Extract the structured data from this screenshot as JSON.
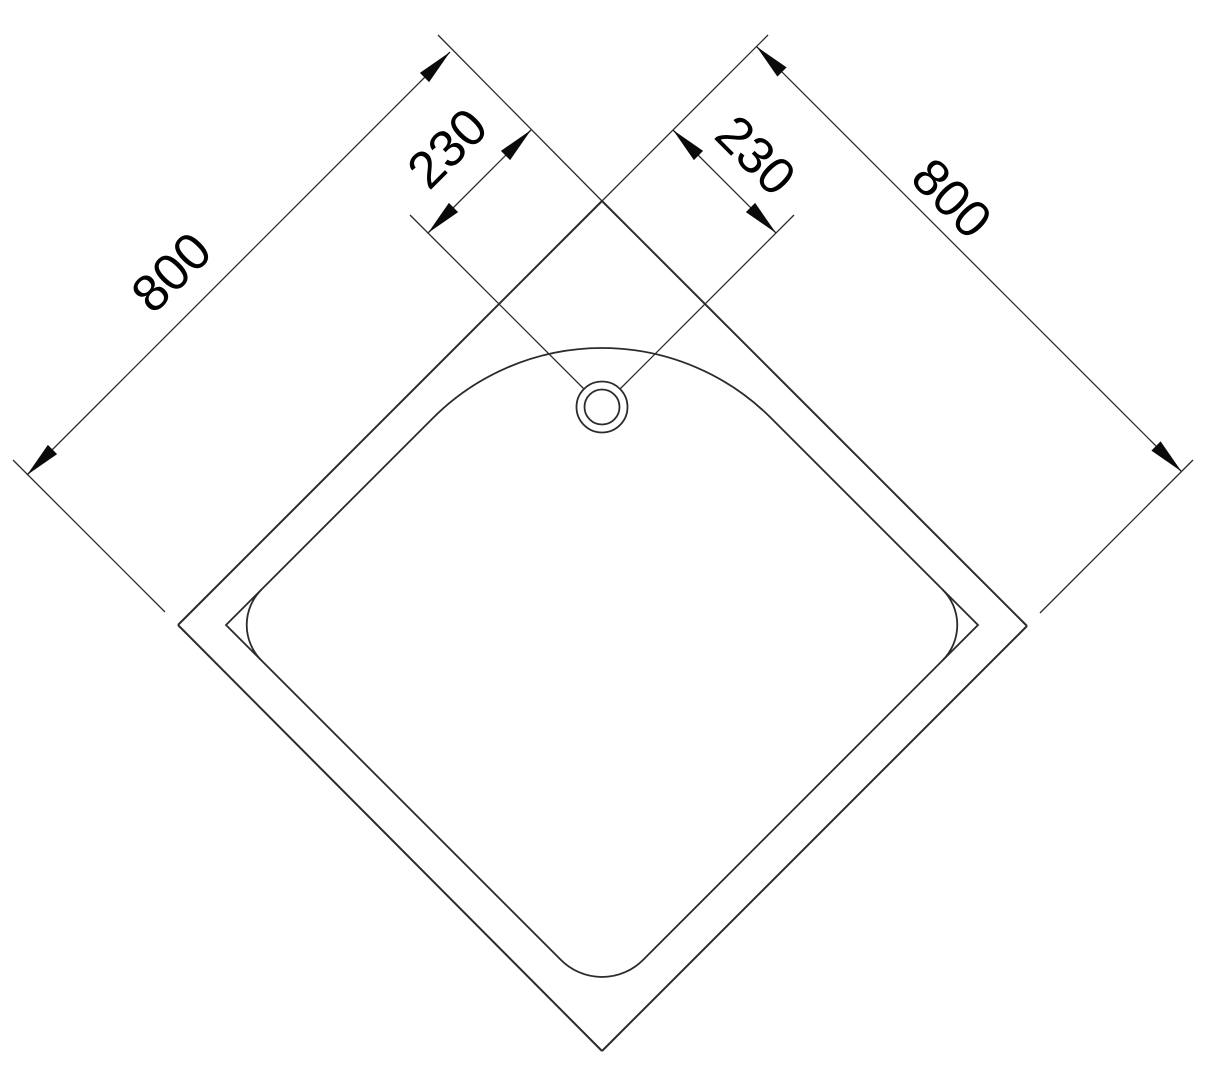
{
  "drawing": {
    "subject": "Square corner shower tray - plan view technical drawing",
    "view": "top view rotated 45 degrees (diamond orientation)",
    "labels": {
      "side_left": "800",
      "side_right": "800",
      "drain_offset_left": "230",
      "drain_offset_right": "230"
    },
    "features": {
      "outer_outline": "square tray outer edge",
      "inner_outline": "basin with rounded corners",
      "drain": "concentric double circle near top corner"
    },
    "colors": {
      "background": "#ffffff",
      "line": "#2b2b2b",
      "text": "#000000"
    }
  }
}
